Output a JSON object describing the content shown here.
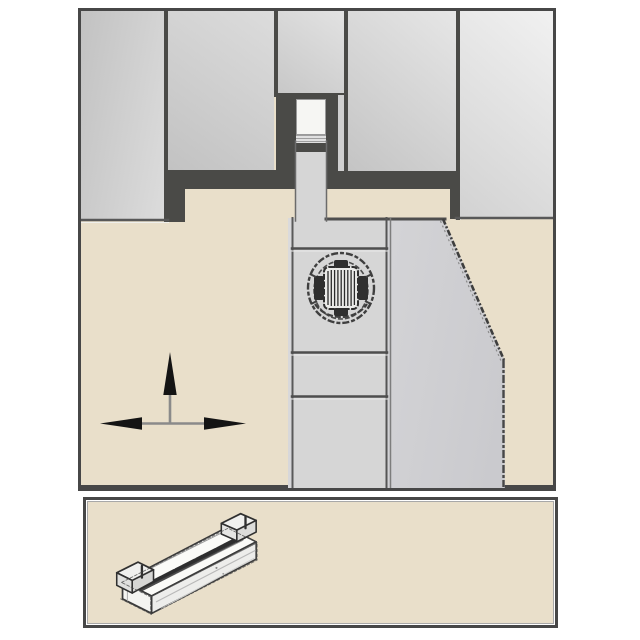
{
  "meta": {
    "description": "Technical catalog illustration: cross-section of a cut-off / grooving tool block with a self-clamped insert blade and clamp screw (top panel); isometric pencil-style sketch of the double-ended grooving insert (bottom panel)",
    "visible_text": ""
  },
  "colors": {
    "page_bg": "#ffffff",
    "beige": "#e9dfca",
    "charcoal": "#4a4a47",
    "border_dark": "#474747",
    "gray_mid": "#c2c2c2",
    "gray_light": "#dcdcdc",
    "gray_blade": "#d6d6d6",
    "insert_white": "#f6f6f3",
    "line_dark": "#4e4e4e",
    "sketch_ink": "#3a3a3a",
    "arrow_black": "#141414",
    "arrow_shaft_gray": "#8a8a8a"
  },
  "panels": {
    "main_diagram": {
      "name": "tool-block-cross-section",
      "elements": [
        "machine-block-columns",
        "clamp-shadow-bands",
        "insert-pocket",
        "clamped-insert-cross-section",
        "blade-column",
        "tool-body-with-chamfer",
        "torx-clamp-screw-head",
        "feed-direction-arrows"
      ]
    },
    "insert_view": {
      "name": "grooving-insert-3d-sketch",
      "elements": [
        "isometric-insert-bar",
        "clamp-steps-both-ends",
        "top-groove-shadow"
      ]
    }
  },
  "icons": {
    "screw": "torx-screw-head-icon",
    "arrows": "feed-directions-icon",
    "insert": "grooving-insert-icon"
  }
}
